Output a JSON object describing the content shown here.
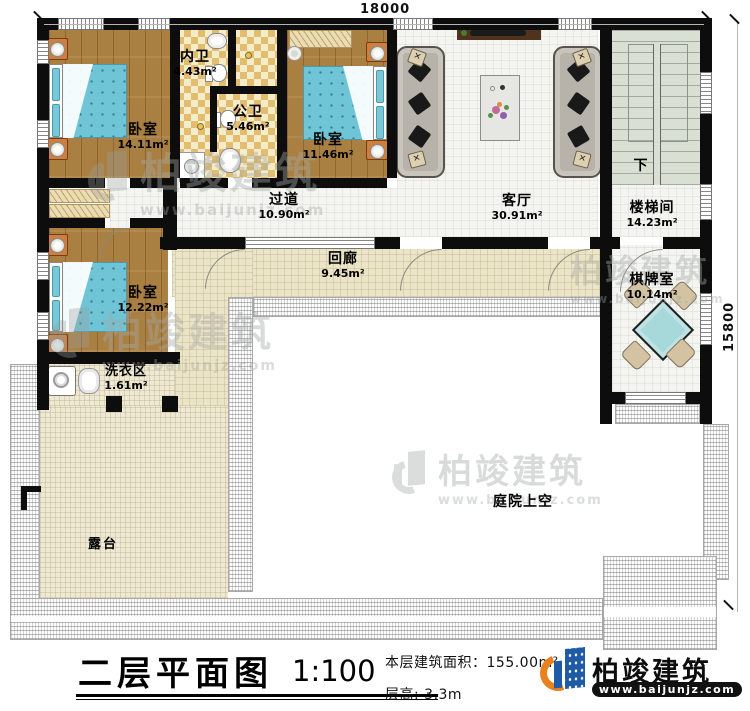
{
  "dimensions": {
    "width_top": "18000",
    "height_right": "15800"
  },
  "rooms": [
    {
      "id": "bedroom-1",
      "name": "卧室",
      "area": "14.11m²"
    },
    {
      "id": "inner-bathroom",
      "name": "内卫",
      "area": "4.43m²"
    },
    {
      "id": "public-bathroom",
      "name": "公卫",
      "area": "5.46m²"
    },
    {
      "id": "bedroom-2",
      "name": "卧室",
      "area": "11.46m²"
    },
    {
      "id": "living-room",
      "name": "客厅",
      "area": "30.91m²"
    },
    {
      "id": "stairwell",
      "name": "楼梯间",
      "area": "14.23m²"
    },
    {
      "id": "hallway",
      "name": "过道",
      "area": "10.90m²"
    },
    {
      "id": "cloister",
      "name": "回廊",
      "area": "9.45m²"
    },
    {
      "id": "bedroom-3",
      "name": "卧室",
      "area": "12.22m²"
    },
    {
      "id": "laundry",
      "name": "洗衣区",
      "area": "1.61m²"
    },
    {
      "id": "chess-room",
      "name": "棋牌室",
      "area": "10.14m²"
    },
    {
      "id": "terrace",
      "name": "露台"
    },
    {
      "id": "courtyard",
      "name": "庭院上空"
    }
  ],
  "stairs": {
    "direction_label": "下"
  },
  "title_block": {
    "title": "二层平面图",
    "scale": "1:100",
    "floor_area": "本层建筑面积：155.00m²",
    "floor_height": "层高: 3.3m"
  },
  "brand": {
    "name": "柏竣建筑",
    "website": "www.baijunjz.com"
  },
  "watermark": {
    "name": "柏竣建筑",
    "website": "www.baijunjz.com"
  },
  "colors": {
    "wall": "#0d0d0d",
    "wood_floor": "#a97f42",
    "mattress": "#6fc4d6",
    "bath_checker": "#e2bd6f",
    "cloister_floor": "#ece4c6",
    "terrace_floor": "#efe8d2",
    "stair_floor": "#d9dfd3",
    "mahjong_table": "#a7d8da",
    "brand_blue": "#1e5aa6",
    "brand_orange": "#e8821e"
  }
}
